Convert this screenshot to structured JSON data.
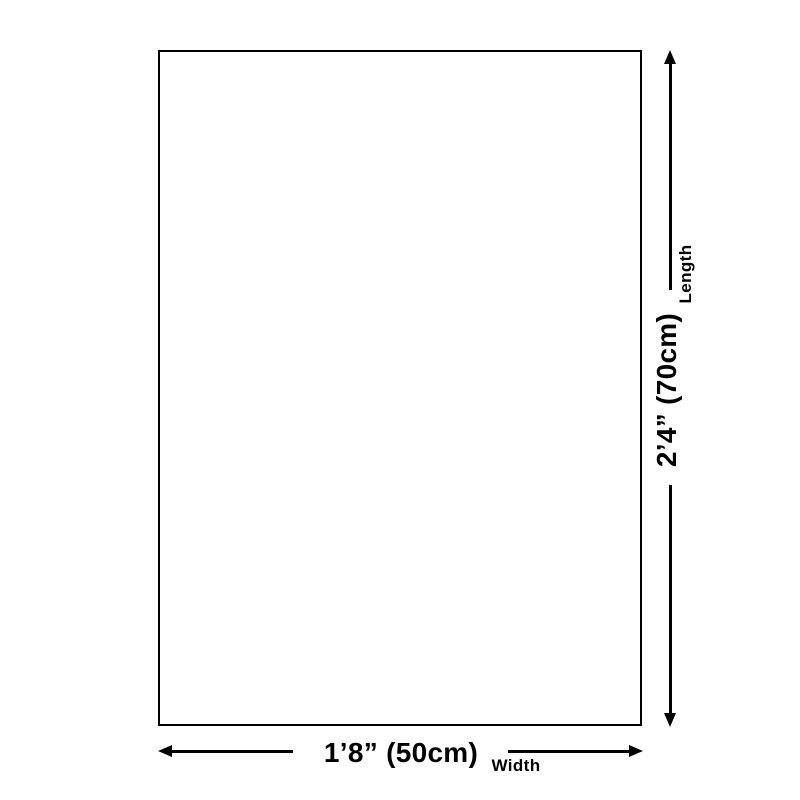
{
  "colors": {
    "background": "#ffffff",
    "foreground": "#000000"
  },
  "diagram": {
    "kind": "product-size-diagram",
    "length": {
      "value": "2’4” (70cm)",
      "label": "Length"
    },
    "width": {
      "value": "1’8” (50cm)",
      "label": "Width"
    }
  }
}
